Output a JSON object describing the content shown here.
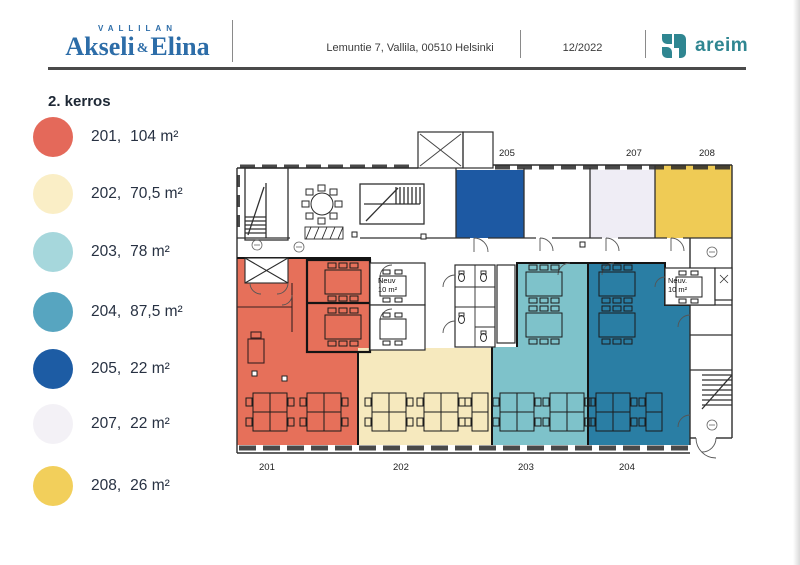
{
  "header": {
    "brand_top": "VALLILAN",
    "brand_left": "Akseli",
    "brand_amp": "&",
    "brand_right": "Elina",
    "address": "Lemuntie 7, Vallila, 00510 Helsinki",
    "date": "12/2022",
    "logo_text": "areim",
    "logo_color": "#2f8691"
  },
  "legend": {
    "title": "2. kerros",
    "items": [
      {
        "room": "201,",
        "area": "104 m²",
        "color": "#e4695a"
      },
      {
        "room": "202,",
        "area": "70,5 m²",
        "color": "#faeec6"
      },
      {
        "room": "203,",
        "area": "78 m²",
        "color": "#a6d7dc"
      },
      {
        "room": "204,",
        "area": "87,5 m²",
        "color": "#57a5c0"
      },
      {
        "room": "205,",
        "area": "22 m²",
        "color": "#1d5ca4"
      },
      {
        "room": "207,",
        "area": "22 m²",
        "color": "#f3f1f6"
      },
      {
        "room": "208,",
        "area": "26 m²",
        "color": "#f2cf5b"
      }
    ]
  },
  "plan": {
    "fills": {
      "r201": "#e6705a",
      "r202": "#f6e9be",
      "r203": "#7ec2ca",
      "r204": "#2a7ea4",
      "r205": "#1d59a3",
      "r207": "#efedf5",
      "r208": "#efcb55"
    },
    "top_labels": [
      "205",
      "207",
      "208"
    ],
    "bottom_labels": [
      "201",
      "202",
      "203",
      "204"
    ],
    "meeting_left": {
      "line1": "Neuv",
      "line2": "10 m²"
    },
    "meeting_right": {
      "line1": "Neuv.",
      "line2": "10 m²"
    }
  }
}
